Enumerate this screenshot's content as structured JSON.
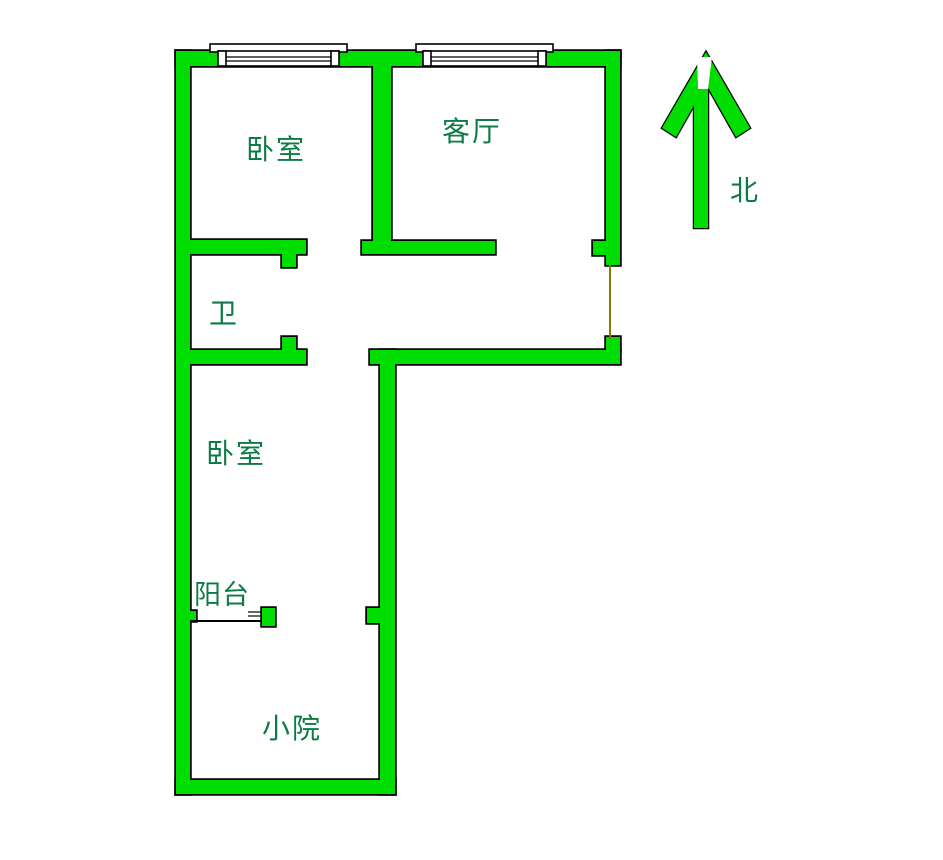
{
  "colors": {
    "wall_fill": "#00dd00",
    "wall_outline": "#000000",
    "label_text": "#0c7b45",
    "opening_line": "#808000",
    "background": "#ffffff",
    "window_fill": "#ffffff"
  },
  "labels": {
    "bedroom_top": "卧室",
    "living_room": "客厅",
    "bathroom": "卫",
    "bedroom_bottom": "卧室",
    "balcony": "阳台",
    "yard": "小院",
    "north": "北"
  }
}
